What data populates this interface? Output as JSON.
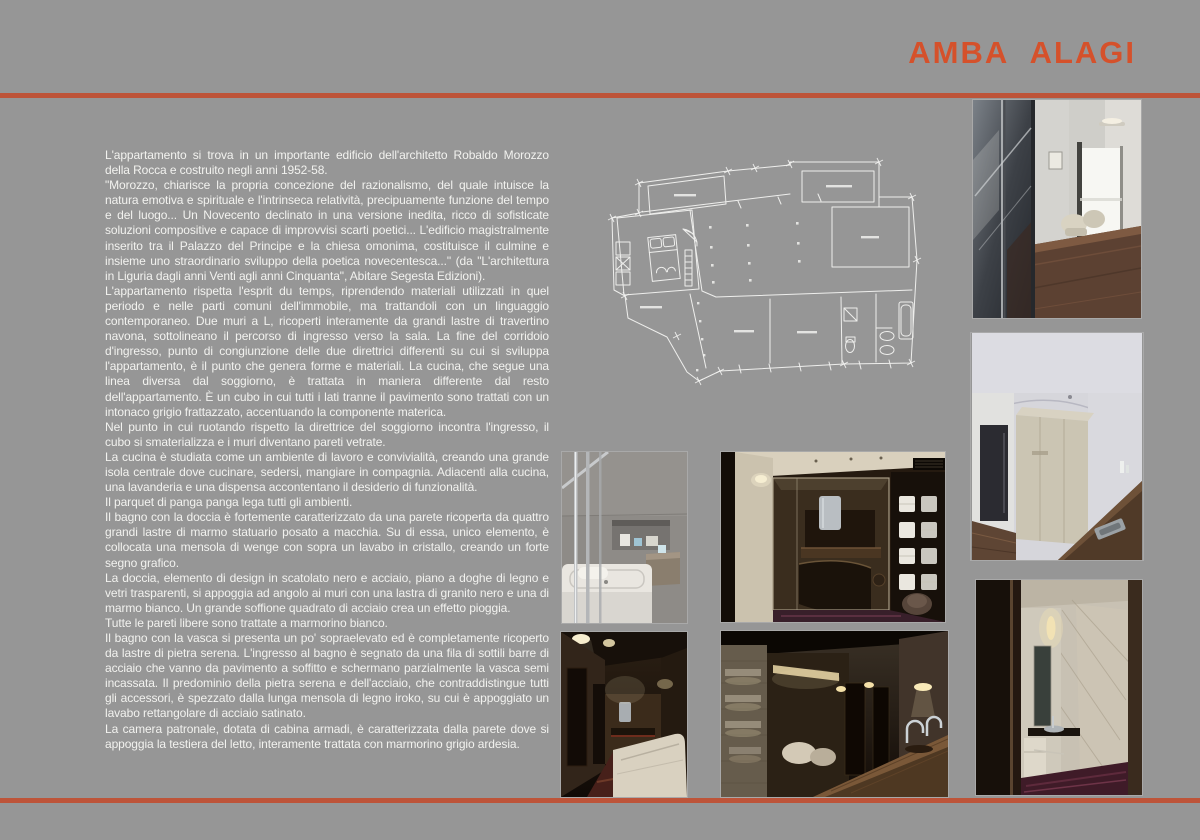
{
  "page": {
    "title": "AMBA  ALAGI",
    "colors": {
      "background": "#969696",
      "accent_title": "#d5512b",
      "accent_rule": "#bd5439",
      "body_text": "#f2f2ef"
    }
  },
  "article": {
    "paragraphs": [
      "L'appartamento si trova in un importante edificio dell'architetto Robaldo Morozzo della Rocca e costruito negli anni 1952-58.",
      "\"Morozzo, chiarisce la propria concezione del razionalismo, del quale intuisce la natura emotiva e spirituale e l'intrinseca relatività, precipuamente funzione del tempo e del luogo... Un Novecento declinato in una versione inedita, ricco di sofisticate soluzioni compositive e capace di improvvisi scarti poetici... L'edificio magistralmente inserito tra il Palazzo del Principe e la chiesa omonima, costituisce il culmine e insieme uno straordinario sviluppo della poetica novecentesca...\" (da \"L'architettura in Liguria dagli anni Venti agli anni Cinquanta\", Abitare Segesta Edizioni).",
      "L'appartamento rispetta l'esprit du temps, riprendendo materiali utilizzati in quel periodo e nelle parti comuni dell'immobile, ma trattandoli con un linguaggio contemporaneo. Due muri a L, ricoperti interamente da grandi lastre di travertino navona, sottolineano il percorso di ingresso verso la sala. La fine del corridoio d'ingresso, punto di congiunzione delle due direttrici differenti su cui si sviluppa l'appartamento, è il punto che genera forme e materiali. La cucina, che segue una linea diversa dal soggiorno, è trattata in maniera differente dal resto dell'appartamento. È un cubo in cui tutti i lati tranne il pavimento sono trattati con un intonaco grigio frattazzato, accentuando la componente materica.",
      "Nel punto in cui ruotando rispetto la direttrice del soggiorno incontra l'ingresso, il cubo si smaterializza e i muri diventano pareti vetrate.",
      "La cucina è studiata come un ambiente di lavoro e convivialità, creando una grande isola centrale dove cucinare, sedersi, mangiare in compagnia. Adiacenti alla cucina, una lavanderia e una dispensa accontentano il desiderio di funzionalità.",
      "Il parquet di panga panga lega tutti gli ambienti.",
      "Il bagno con la doccia è fortemente caratterizzato da una parete ricoperta da quattro grandi lastre di marmo statuario posato a macchia. Su di essa, unico elemento, è collocata una mensola di wenge con sopra un lavabo in cristallo, creando un forte segno grafico.",
      "La doccia, elemento di design in scatolato nero e acciaio, piano a doghe di legno e vetri trasparenti, si appoggia ad angolo ai muri con una lastra di granito nero e una di marmo bianco. Un grande soffione quadrato di acciaio crea un effetto pioggia.",
      "Tutte le pareti libere sono trattate a marmorino bianco.",
      "Il bagno con la vasca si presenta un po' sopraelevato ed è completamente ricoperto da lastre di pietra serena. L'ingresso al bagno è segnato da una fila di sottili barre di acciaio che vanno da pavimento a soffitto e schermano parzialmente la vasca semi incassata. Il predominio della pietra serena e dell'acciaio, che contraddistingue tutti gli accessori, è spezzato dalla lunga mensola di legno iroko, su cui è appoggiato un lavabo rettangolare di acciaio satinato.",
      "La camera patronale, dotata di cabina armadi, è caratterizzata dalla parete dove si appoggia la testiera del letto, interamente trattata con marmorino grigio ardesia."
    ]
  },
  "figures": {
    "floor_plan": {
      "name": "apartment-floor-plan"
    },
    "photos": [
      {
        "name": "hallway-glass-partition"
      },
      {
        "name": "bathroom-marble-shower"
      },
      {
        "name": "bathroom-dark-marble-sink"
      },
      {
        "name": "bathtub-with-steel-bars"
      },
      {
        "name": "kitchen-glass-cube"
      },
      {
        "name": "night-corridor-sofa"
      },
      {
        "name": "kitchen-island-counter"
      }
    ]
  }
}
